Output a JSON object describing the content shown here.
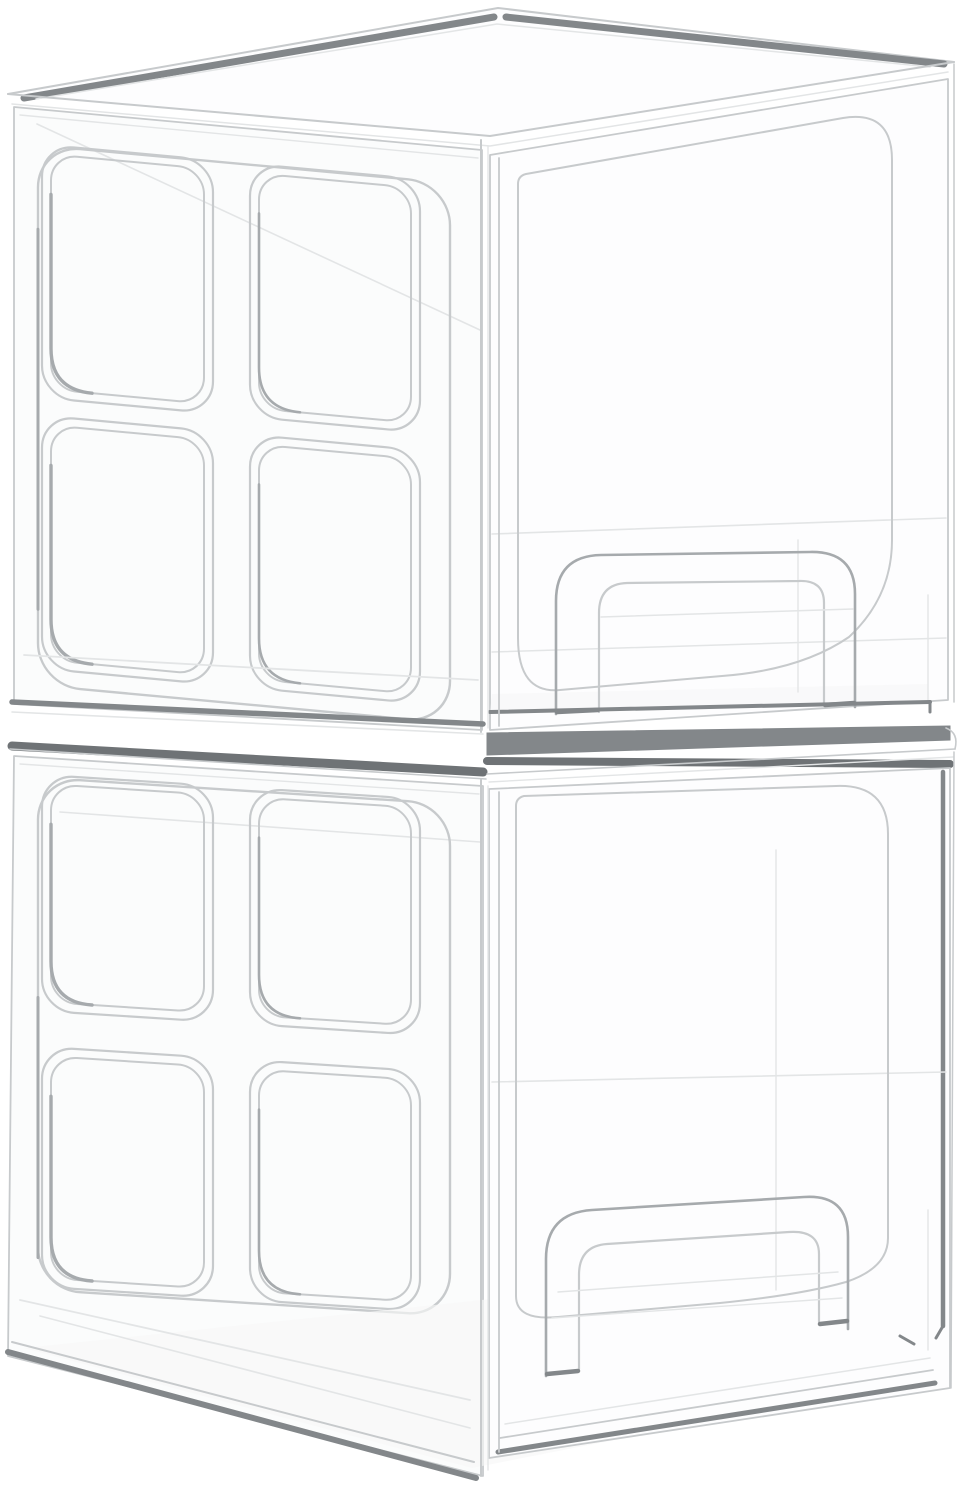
{
  "page": {
    "background": "#ffffff",
    "alt": "Two stacked transparent acrylic pull-out drawer organizers on a plain white background"
  },
  "palette": {
    "bg": "#ffffff",
    "face": "#fdfdfe",
    "face-side": "#fbfcfc",
    "floor": "#f7f8f8",
    "edge-faint": "#e3e5e6",
    "edge-light": "#c7cacc",
    "edge-mid": "#a6aaad",
    "edge-dark": "#83878a",
    "edge-darker": "#6f7376"
  },
  "product": {
    "name": "Stackable clear acrylic drawer organizers",
    "appearance": "transparent acrylic, thin gray edge lines, no printed text",
    "units_visible": 2,
    "stacked": true,
    "unit_top": {
      "lid": "flat clear lid with dark gray back-edge highlights",
      "side_panel": "left side with 2x2 grid of rounded-square window cutouts",
      "front": "clear drawer front with large rounded-rectangle cutout outline",
      "handle": "arched clear pull handle at lower center of drawer front"
    },
    "unit_bottom": {
      "lid": "flat clear lid partly hidden under top unit, dark back-edge highlight",
      "side_panel": "left side with 2x2 grid of rounded-square window cutouts",
      "front": "clear drawer front with large rounded-rectangle cutout outline and dark right-edge highlight",
      "handle": "arched clear pull handle at lower center of drawer front"
    },
    "window_grid": {
      "rows": 2,
      "cols": 2
    }
  }
}
